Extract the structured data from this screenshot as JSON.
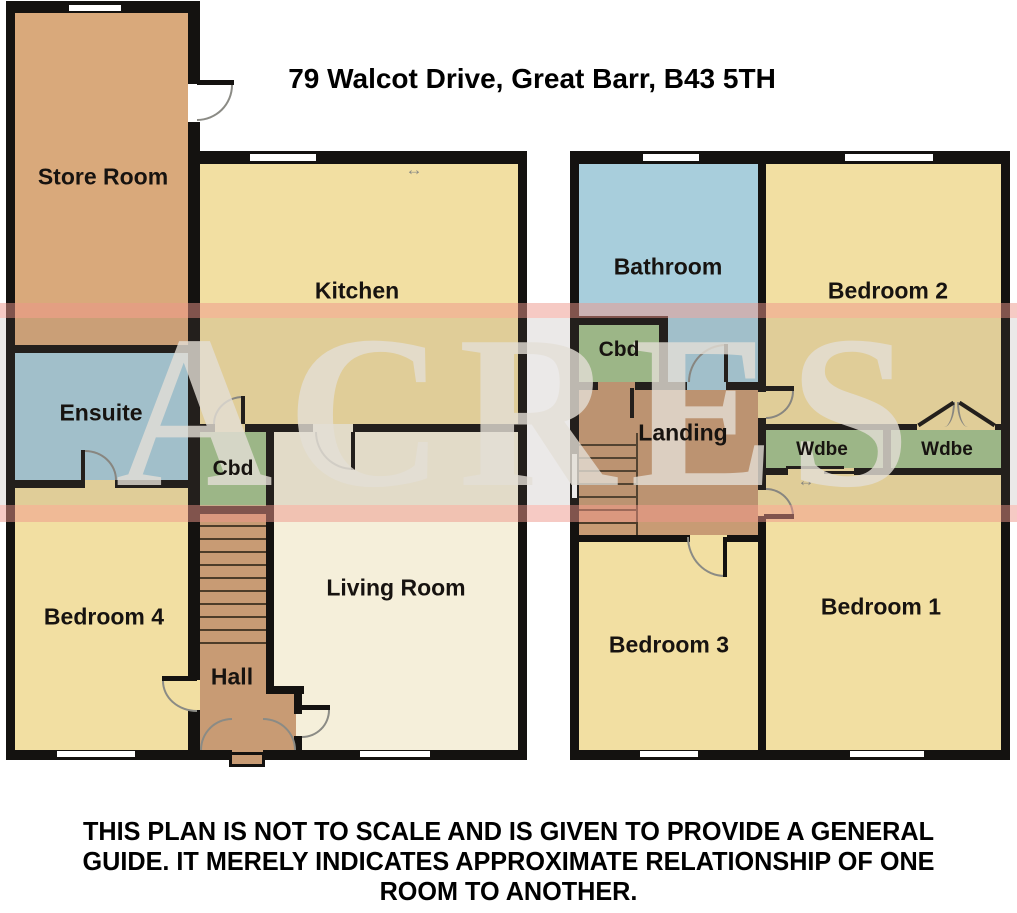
{
  "title": "79 Walcot Drive, Great Barr, B43 5TH",
  "watermark": "ACRES",
  "disclaimer": "THIS PLAN IS NOT TO SCALE AND IS GIVEN TO PROVIDE A GENERAL\nGUIDE. IT MERELY INDICATES APPROXIMATE RELATIONSHIP OF ONE\nROOM TO ANOTHER.",
  "rooms": {
    "store": {
      "label": "Store Room"
    },
    "kitchen": {
      "label": "Kitchen"
    },
    "ensuite": {
      "label": "Ensuite"
    },
    "cbd_ground": {
      "label": "Cbd"
    },
    "bedroom4": {
      "label": "Bedroom 4"
    },
    "hall": {
      "label": "Hall"
    },
    "living": {
      "label": "Living Room"
    },
    "bathroom": {
      "label": "Bathroom"
    },
    "cbd_first": {
      "label": "Cbd"
    },
    "bedroom2": {
      "label": "Bedroom 2"
    },
    "landing": {
      "label": "Landing"
    },
    "wdbe_left": {
      "label": "Wdbe"
    },
    "wdbe_right": {
      "label": "Wdbe"
    },
    "bedroom3": {
      "label": "Bedroom 3"
    },
    "bedroom1": {
      "label": "Bedroom 1"
    }
  },
  "icons": {
    "sliding_arrow": "↔"
  },
  "colors": {
    "wall": "#141210",
    "arc": "#8b8b85",
    "room_tan": "#d9a97b",
    "room_tan_dark": "#c89b74",
    "room_yellow": "#f2dfa2",
    "room_blue": "#a8cedc",
    "room_green": "#a3c48e",
    "room_cream": "#f5efda",
    "watermark_band": "#ee968a"
  }
}
